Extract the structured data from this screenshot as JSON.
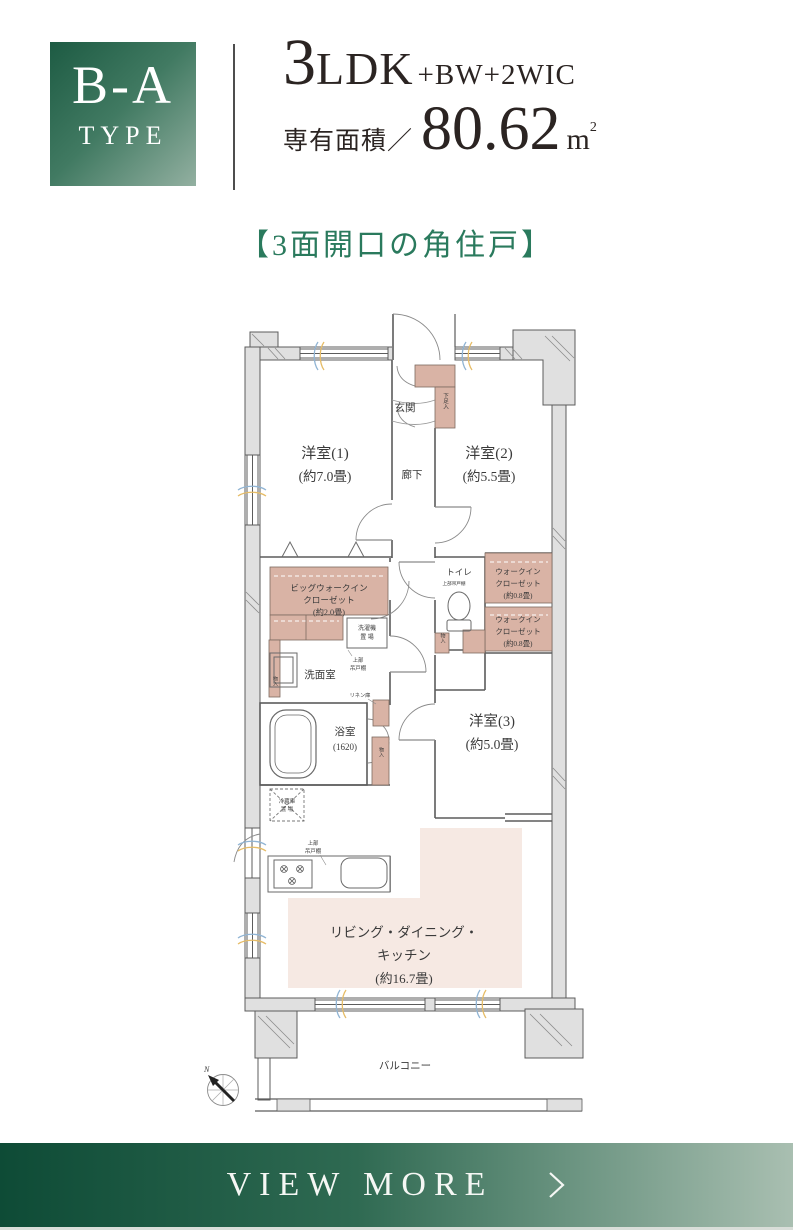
{
  "header": {
    "type_code": "B-A",
    "type_word": "TYPE",
    "plan_number": "3",
    "plan_type": "LDK",
    "plan_suffix": "+BW+2WIC",
    "area_label": "専有面積／",
    "area_value": "80.62",
    "area_unit": "m",
    "area_exp": "2",
    "catchcopy": "【3面開口の角住戸】"
  },
  "plan": {
    "room1": {
      "name": "洋室(1)",
      "size": "(約7.0畳)"
    },
    "room2": {
      "name": "洋室(2)",
      "size": "(約5.5畳)"
    },
    "room3": {
      "name": "洋室(3)",
      "size": "(約5.0畳)"
    },
    "ldk": {
      "line1": "リビング・ダイニング・",
      "line2": "キッチン",
      "line3": "(約16.7畳)"
    },
    "genkan": "玄関",
    "hallway": "廊下",
    "toilet": "トイレ",
    "washroom": "洗面室",
    "bath": {
      "name": "浴室",
      "size": "(1620)"
    },
    "big_wic": {
      "line1": "ビッグウォークイン",
      "line2": "クローゼット",
      "line3": "(約2.0畳)"
    },
    "wic": {
      "line1": "ウォークイン",
      "line2": "クローゼット",
      "line3": "(約0.8畳)"
    },
    "shoe_box": "下足入",
    "storage": "物入",
    "washer": {
      "line1": "洗濯機",
      "line2": "置 場"
    },
    "upper_cabinet": {
      "line1": "上部",
      "line2": "吊戸棚",
      "inline": "上部吊戸棚"
    },
    "fridge": {
      "line1": "冷蔵庫",
      "line2": "置 場"
    },
    "linen": "リネン庫",
    "balcony": "バルコニー",
    "compass_north": "N"
  },
  "footer": {
    "view_more": "VIEW MORE"
  },
  "colors": {
    "brand_green_dark": "#1d5b43",
    "brand_green_light": "#93b0a1",
    "catch_green": "#2a7a5d",
    "closet_pink": "#d9b3a5",
    "ldk_pink": "#f6e9e3",
    "wall_gray": "#e0e0e0",
    "line_gray": "#5c5c5c",
    "airflow_blue": "#90b4d4",
    "airflow_yellow": "#e6bc66"
  }
}
